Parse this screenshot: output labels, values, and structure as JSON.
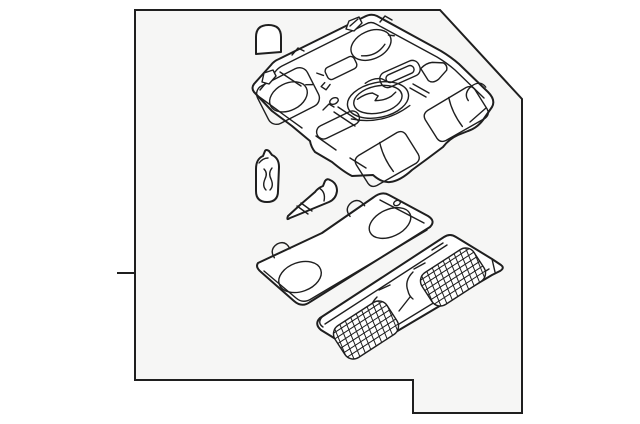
{
  "frame": {
    "background": "#ffffff",
    "panel_fill": "#f6f6f5",
    "line_color": "#1f1f1f",
    "part_fill": "#ffffff"
  },
  "diagram": {
    "type": "exploded-parts-line-art",
    "parts": [
      {
        "name": "dome bulb cover"
      },
      {
        "name": "overhead console housing"
      },
      {
        "name": "wedge base bulb"
      },
      {
        "name": "bulb socket"
      },
      {
        "name": "lamp lens plate"
      },
      {
        "name": "grille lens panel"
      }
    ]
  }
}
